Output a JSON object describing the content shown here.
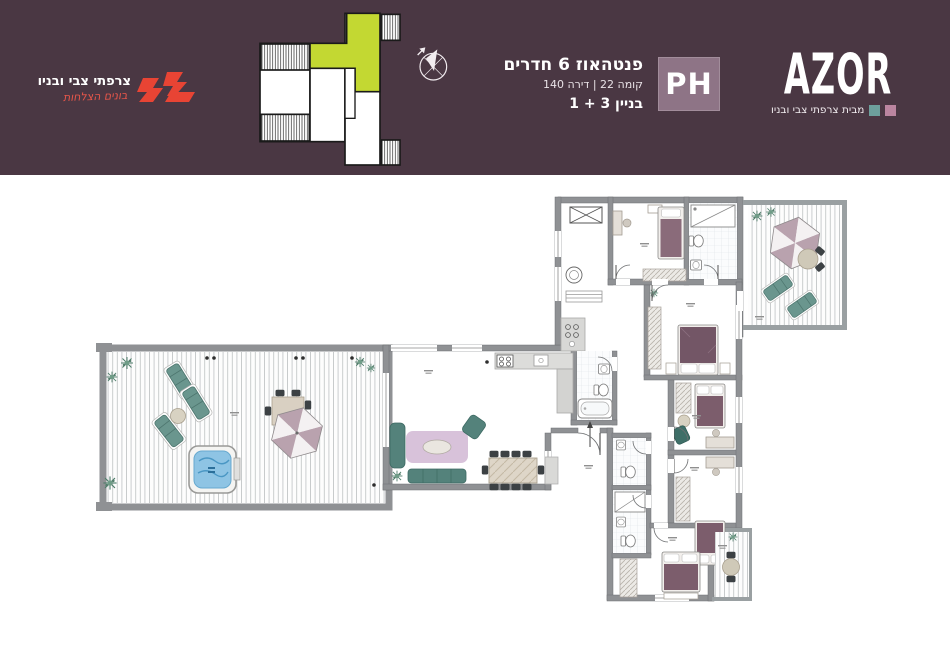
{
  "header": {
    "background": "#4a3743",
    "developer": {
      "name": "צרפתי צבי ובניו",
      "tagline": "בונים הצלחות",
      "logo_red": "#e84434"
    },
    "key_plan": {
      "unit_highlight": "#c3d832"
    },
    "unit": {
      "type": "פנטהאוז 6 חדרים",
      "floor_line": "קומה 22 | דירה 140",
      "building_line": "בניין 3 + 1",
      "badge": "PH"
    },
    "brand": {
      "name": "AZOR",
      "byline": "מבית צרפתי צבי ובניו",
      "teal": "#6d9f9c",
      "pink": "#bb85a0",
      "badge_bg": "#8e7486"
    }
  },
  "floor_plan": {
    "colors": {
      "wall": "#8f9194",
      "deck_line": "#c5c8c9",
      "furniture_teal": "#5f8f88",
      "bed": "#7c5d6c",
      "rug": "#cbaecd",
      "jacuzzi": "#8ec4e4",
      "tile_line": "#dde3e7",
      "wood": "#ded6c8"
    }
  }
}
